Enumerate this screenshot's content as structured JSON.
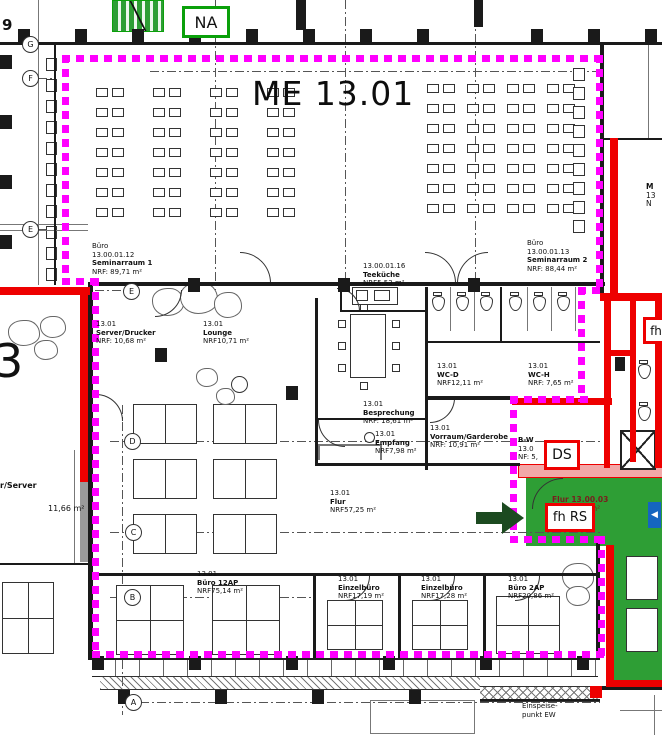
{
  "title": "ME 13.01",
  "badges": {
    "na": "NA",
    "ds": "DS",
    "fh_rs": "fh RS",
    "fh": "fh"
  },
  "grid_bubbles": {
    "g": "G",
    "f": "F",
    "e": "E",
    "e2": "E",
    "d": "D",
    "c": "C",
    "b": "B",
    "a": "A"
  },
  "partial_text": {
    "top_left": "9",
    "mid_left": "3",
    "right_edge": [
      "M",
      "13",
      "N"
    ]
  },
  "rooms": {
    "seminarraum1": {
      "lines": [
        "Büro",
        "13.00.01.12",
        "Seminarraum 1",
        "NRF: 89,71 m²"
      ]
    },
    "seminarraum2": {
      "lines": [
        "Büro",
        "13.00.01.13",
        "Seminarraum 2",
        "NRF: 88,44 m²"
      ]
    },
    "teekueche": {
      "lines": [
        "13.00.01.16",
        "Teeküche",
        "NRF5,53 m²"
      ]
    },
    "server_drucker": {
      "lines": [
        "13.01",
        "Server/Drucker",
        "NRF: 10,68 m²"
      ]
    },
    "lounge": {
      "lines": [
        "13.01",
        "Lounge",
        "NRF10,71 m²"
      ]
    },
    "wc_d": {
      "lines": [
        "13.01",
        "WC-D",
        "NRF12,11 m²"
      ]
    },
    "wc_h": {
      "lines": [
        "13.01",
        "WC-H",
        "NRF: 7,65 m²"
      ]
    },
    "besprechung": {
      "lines": [
        "13.01",
        "Besprechung",
        "NRF: 18,61 m²"
      ]
    },
    "empfang": {
      "lines": [
        "13.01",
        "Empfang",
        "NRF7,98 m²"
      ]
    },
    "vorraum_garderobe": {
      "lines": [
        "13.01",
        "Vorraum/Garderobe",
        "NRF: 10,91 m²"
      ]
    },
    "flur": {
      "lines": [
        "13.01",
        "Flur",
        "NRF57,25 m²"
      ]
    },
    "buero_12ap": {
      "lines": [
        "13.01",
        "Büro 12AP",
        "NRF75,14 m²"
      ]
    },
    "einzelbuero_1": {
      "lines": [
        "13.01",
        "Einzelbüro",
        "NRF17,19 m²"
      ]
    },
    "einzelbuero_2": {
      "lines": [
        "13.01",
        "Einzelbüro",
        "NRF17,28 m²"
      ]
    },
    "buero_2ap": {
      "lines": [
        "13.01",
        "Büro 2AP",
        "NRF20,86 m²"
      ]
    },
    "server_links": {
      "lines": [
        "r/Server",
        "11,66 m²"
      ]
    },
    "bw_raum": {
      "lines": [
        "B-W",
        "13.0",
        "NF: 5,"
      ]
    },
    "flur_13_00_03": {
      "lines": [
        "Flur 13.00.03",
        "18,84 m²"
      ]
    },
    "einspeisepunkt": {
      "lines": [
        "Einspeise-",
        "punkt EW"
      ]
    }
  },
  "colors": {
    "magenta": "#FF00FF",
    "red": "#EE0000",
    "green": "#2E9E35",
    "pink": "#F2A8A8",
    "blue": "#1565C0",
    "arrow": "#1C4A20",
    "nagreen": "#0AA00A",
    "darkred": "#7A1D1D"
  }
}
